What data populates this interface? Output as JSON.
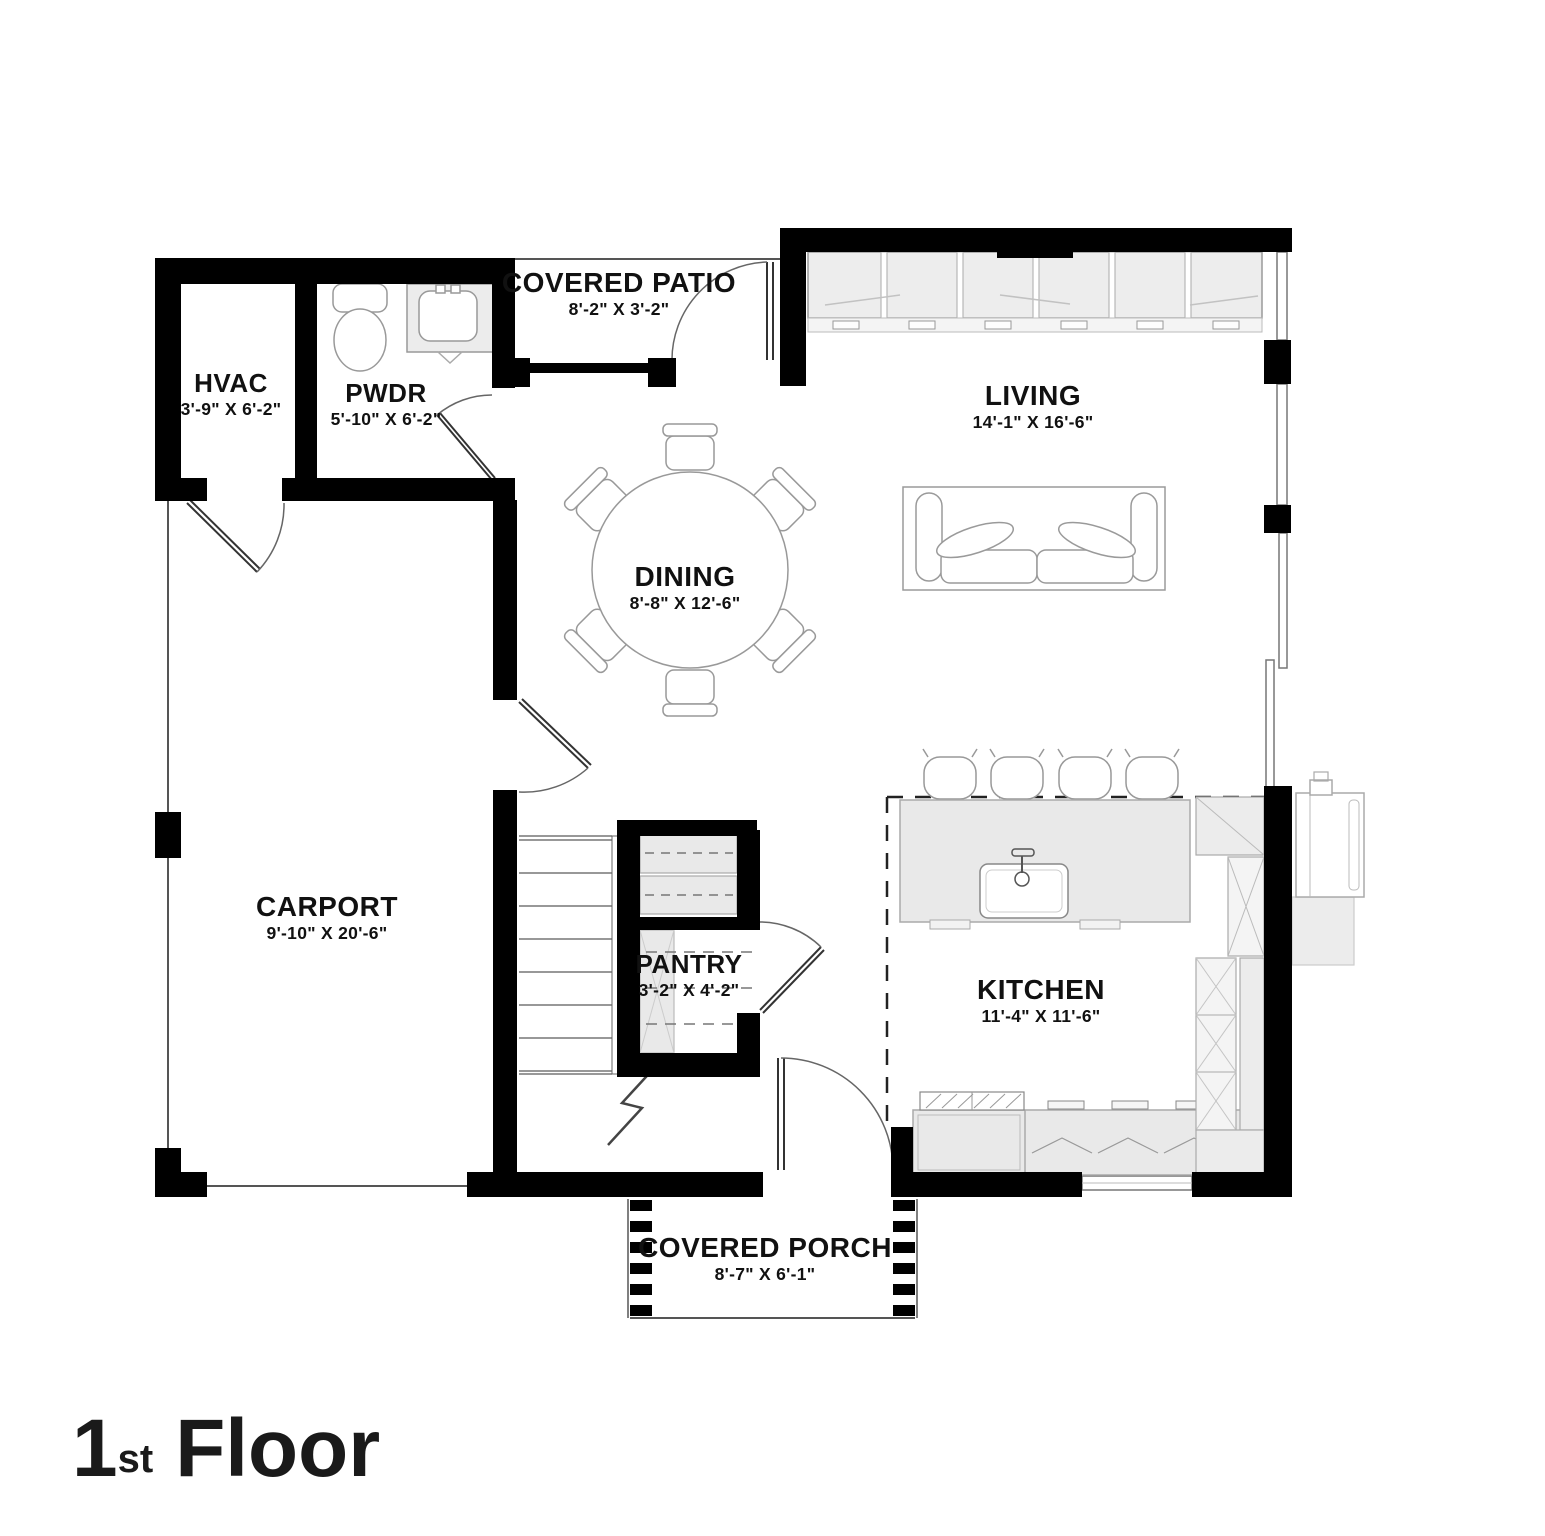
{
  "plan": {
    "title": {
      "number": "1",
      "ordinal": "st",
      "word": "Floor"
    },
    "rooms": [
      {
        "name": "HVAC",
        "dims": "3'-9\" X 6'-2\""
      },
      {
        "name": "PWDR",
        "dims": "5'-10\" X 6'-2\""
      },
      {
        "name": "COVERED PATIO",
        "dims": "8'-2\" X 3'-2\""
      },
      {
        "name": "LIVING",
        "dims": "14'-1\" X 16'-6\""
      },
      {
        "name": "DINING",
        "dims": "8'-8\" X 12'-6\""
      },
      {
        "name": "CARPORT",
        "dims": "9'-10\" X 20'-6\""
      },
      {
        "name": "PANTRY",
        "dims": "3'-2\" X 4'-2\""
      },
      {
        "name": "KITCHEN",
        "dims": "11'-4\" X 11'-6\""
      },
      {
        "name": "COVERED PORCH",
        "dims": "8'-7\" X 6'-1\""
      }
    ],
    "colors": {
      "wall": "#000000",
      "fixture_fill": "#ebebeb",
      "fixture_line": "#9a9a9a",
      "text": "#111111",
      "background": "#ffffff"
    }
  }
}
